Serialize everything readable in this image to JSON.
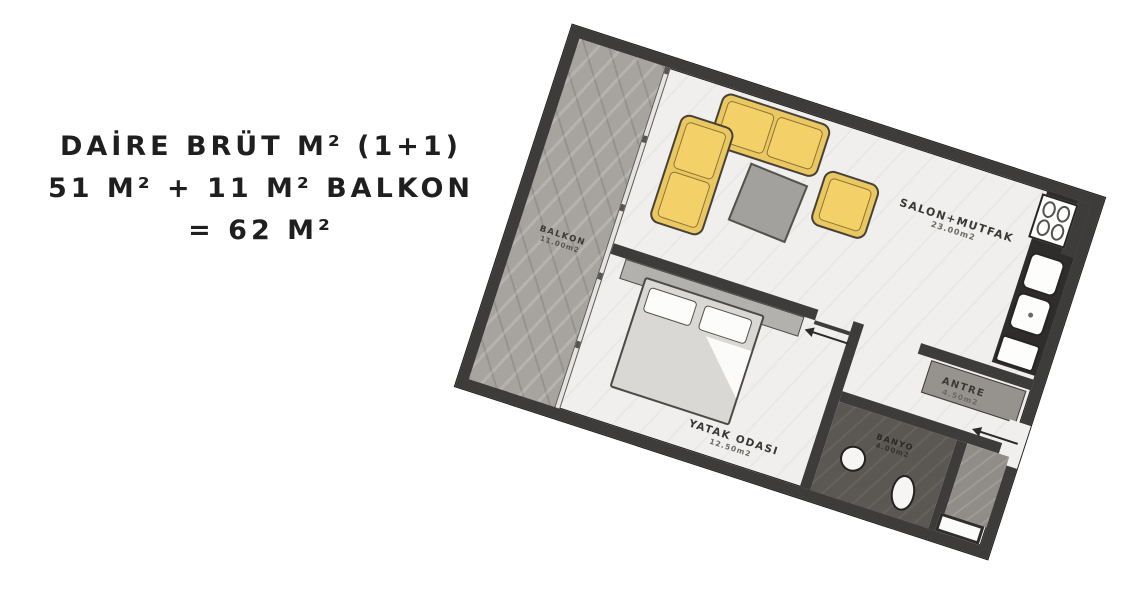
{
  "headline": {
    "lines": [
      "DAİRE BRÜT M² (1+1)",
      "51 M² + 11 M² BALKON",
      "= 62 M²"
    ],
    "color": "#1f1f1f"
  },
  "floorplan": {
    "type": "apartment-floor-plan",
    "unit_type": "1+1",
    "rotation_deg": 18,
    "rooms": [
      {
        "id": "balkon",
        "label": "BALKON",
        "area": "11.00m2"
      },
      {
        "id": "salon",
        "label": "SALON+MUTFAK",
        "area": "23.00m2"
      },
      {
        "id": "yatak",
        "label": "YATAK ODASI",
        "area": "12.50m2"
      },
      {
        "id": "antre",
        "label": "ANTRE",
        "area": "4.50m2"
      },
      {
        "id": "banyo",
        "label": "BANYO",
        "area": "4.00m2"
      }
    ],
    "colors": {
      "wall": "#3d3c3a",
      "balcony_floor": "#a7a4a0",
      "interior_floor": "#f0efed",
      "bathroom_floor": "#5b5853",
      "sofa": "#eac760",
      "coffee_table": "#a3a19e",
      "bed": "#d9d8d5",
      "counter": "#2f2d2b",
      "fixtures": "#ffffff"
    }
  }
}
